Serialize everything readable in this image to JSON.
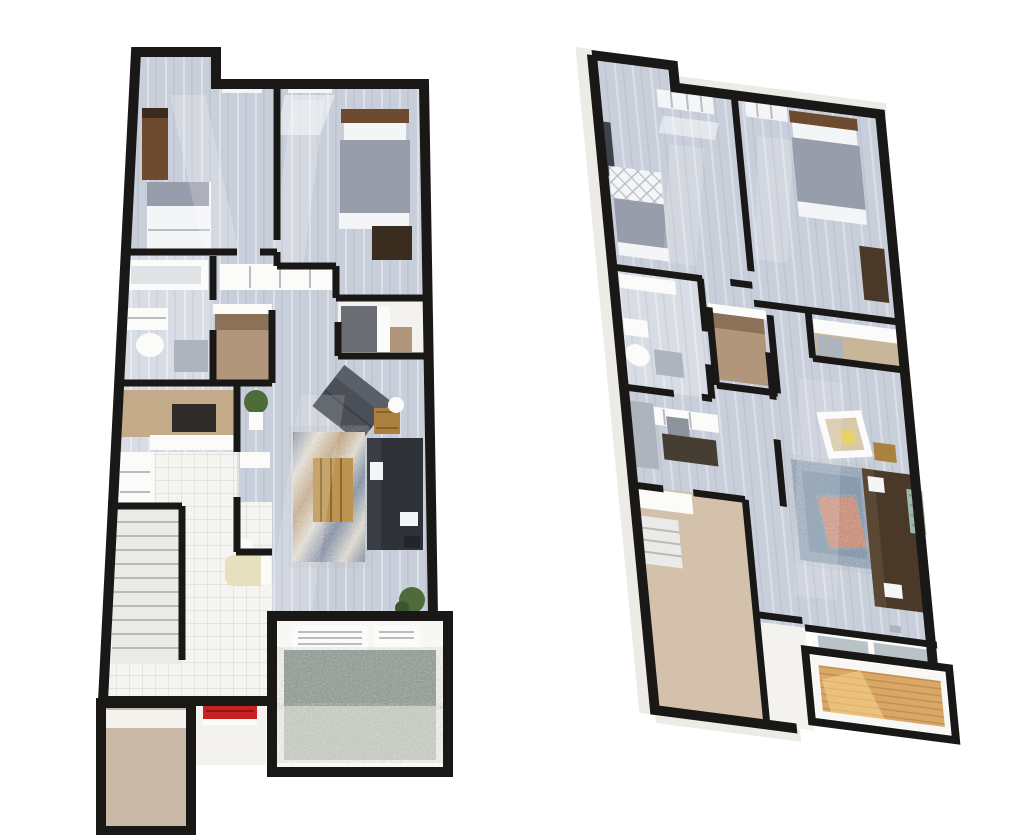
{
  "image_type": "3d-floor-plan-pair",
  "palette": {
    "background": "#ffffff",
    "wall": "#191817",
    "wall_outer_face": "#edebe5",
    "floor_plank": "#c9cfda",
    "floor_plank_light": "#d8dce4",
    "floor_tile": "#f4f4f1",
    "tile_line": "#dadad4",
    "floor_tan": "#c8baa6",
    "floor_tan_right": "#d4c1ac",
    "kitchen_backwall": "#c3ab89",
    "closet_tan": "#b2967b",
    "closet_tan_dark": "#8a7158",
    "stair_light": "#eaeae8",
    "stair_line": "#b9b9b5",
    "gravel_dark": "#8f9a93",
    "gravel_light": "#ccd1c5",
    "deck_white": "#f7f7f4",
    "balcony_wood": "#d9a869",
    "balcony_wood_dark": "#c18e4e",
    "balcony_light": "#ffd98f",
    "red_accent": "#c92121",
    "sofa_dark": "#30323a",
    "sofa_brown": "#4a3829",
    "armchair_gray": "#4b4f58",
    "armchair_cream": "#d8c9ab",
    "wood_brown": "#6e4b2e",
    "table_brass": "#ab813f",
    "coffee_wood": "#bd9450",
    "rug_blue": "#7e8da6",
    "rug_tan": "#c3a274",
    "rug_cream": "#e9e4d8",
    "rug_right": "#92a6ba",
    "rug_right_dark": "#7089a0",
    "ottoman_salmon": "#d08a6e",
    "bed_gray": "#979daa",
    "bed_white": "#f4f5f7",
    "quilt_line": "#b9bfca",
    "fixture_white": "#fbfbfa",
    "fixture_gray": "#aeb4bd",
    "plant_green": "#4e6b3c",
    "desk_dark": "#473e33",
    "glass_gray": "#b9c2c6",
    "cream_tub": "#e6e0bf",
    "white_soft": "#f3f2ee",
    "dark_wardrobe": "#3f4246",
    "bench_dark": "#3a2d20",
    "cooktop": "#2e2b28",
    "shade": "#dfe3e6",
    "chair_gray": "#8d939c",
    "tan_shelf_floor": "#c9b698",
    "charcoal_box": "#6a6e74"
  },
  "plans": {
    "left": {
      "icons": [
        "wardrobe-icon",
        "bed-icon",
        "window-icon",
        "headboard-icon",
        "bench-icon",
        "bathtub-icon",
        "sink-icon",
        "toilet-icon",
        "shower-icon",
        "shelf-icon",
        "closet-icon",
        "cooktop-icon",
        "counter-icon",
        "armchair-icon",
        "side-table-lamp-icon",
        "rug-icon",
        "coffee-table-icon",
        "sofa-icon",
        "plant-icon",
        "stairs-icon",
        "powder-tub-icon",
        "entry-bench-icon",
        "garage-floor-icon",
        "patio-lounge-chair-icon",
        "gravel-icon"
      ]
    },
    "right": {
      "icons": [
        "wardrobe-icon",
        "quilted-bed-icon",
        "window-icon",
        "headboard-icon",
        "dresser-icon",
        "toilet-icon",
        "sink-icon",
        "closet-icon",
        "shelf-icon",
        "desk-icon",
        "desk-chair-icon",
        "armchair-icon",
        "side-table-icon",
        "rug-icon",
        "ottoman-icon",
        "sofa-icon",
        "throw-blanket-icon",
        "stairs-icon",
        "sliding-door-icon",
        "balcony-deck-icon"
      ]
    }
  }
}
